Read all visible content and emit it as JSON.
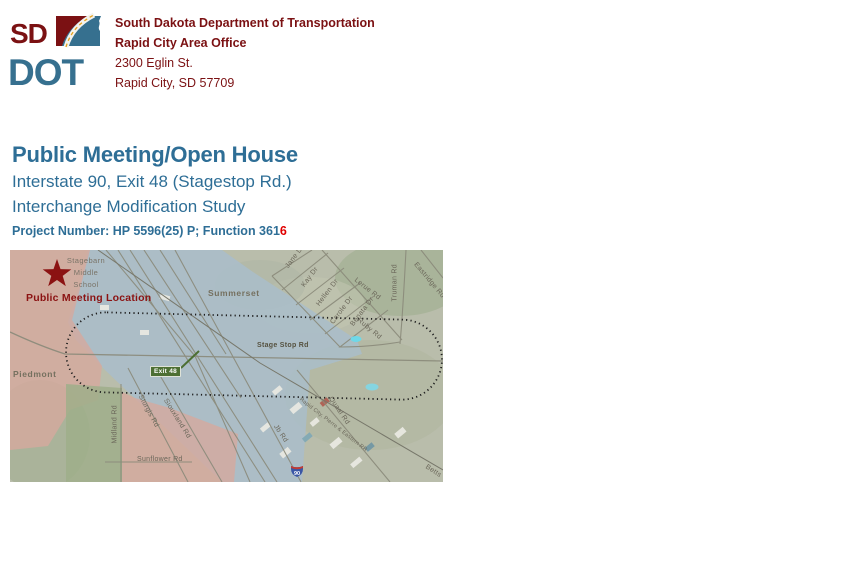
{
  "header": {
    "logo": {
      "sd": "SD",
      "dot": "DOT"
    },
    "org_lines": [
      "South Dakota Department of Transportation",
      "Rapid City Area Office",
      "2300 Eglin St.",
      "Rapid City, SD 57709"
    ]
  },
  "title": {
    "heading": "Public Meeting/Open House",
    "subtitle_line1": "Interstate 90, Exit 48 (Stagestop Rd.)",
    "subtitle_line2": "Interchange Modification Study",
    "project_prefix": "Project Number: HP 5596(25) P; Function 361",
    "project_suffix": "6"
  },
  "map": {
    "meeting_label": "Public Meeting Location",
    "school": [
      "Stagebarn",
      "Middle",
      "School"
    ],
    "towns": {
      "summerset": "Summerset",
      "piedmont": "Piedmont"
    },
    "exit_sign": "Exit 48",
    "shield": "90",
    "roads": {
      "stage_stop": "Stage Stop Rd",
      "jane": "Jane Dr",
      "kay": "Kay Dr",
      "hellen": "Hellen Dr",
      "carole": "Carole Dr",
      "benata": "Benata Dr",
      "ruby": "Ruby Rd",
      "lerue": "Lerue Rd",
      "truman": "Truman Rd",
      "eastridge": "Eastridge Rd",
      "sturgis": "Sturgis Rd",
      "siouxland": "Siouxland Rd",
      "midland": "Midland Rd",
      "sunflower": "Sunflower Rd",
      "quaal": "Quaal Rd",
      "jb": "Jb Rd",
      "rr": "Rapid City, Pierre & Eastern RR",
      "betts": "Betts"
    }
  },
  "colors": {
    "maroon": "#7b1113",
    "title_blue": "#2e6e96",
    "logo_blue": "#36708f",
    "exit_green": "#4d6f33",
    "project_red": "#e00000"
  }
}
